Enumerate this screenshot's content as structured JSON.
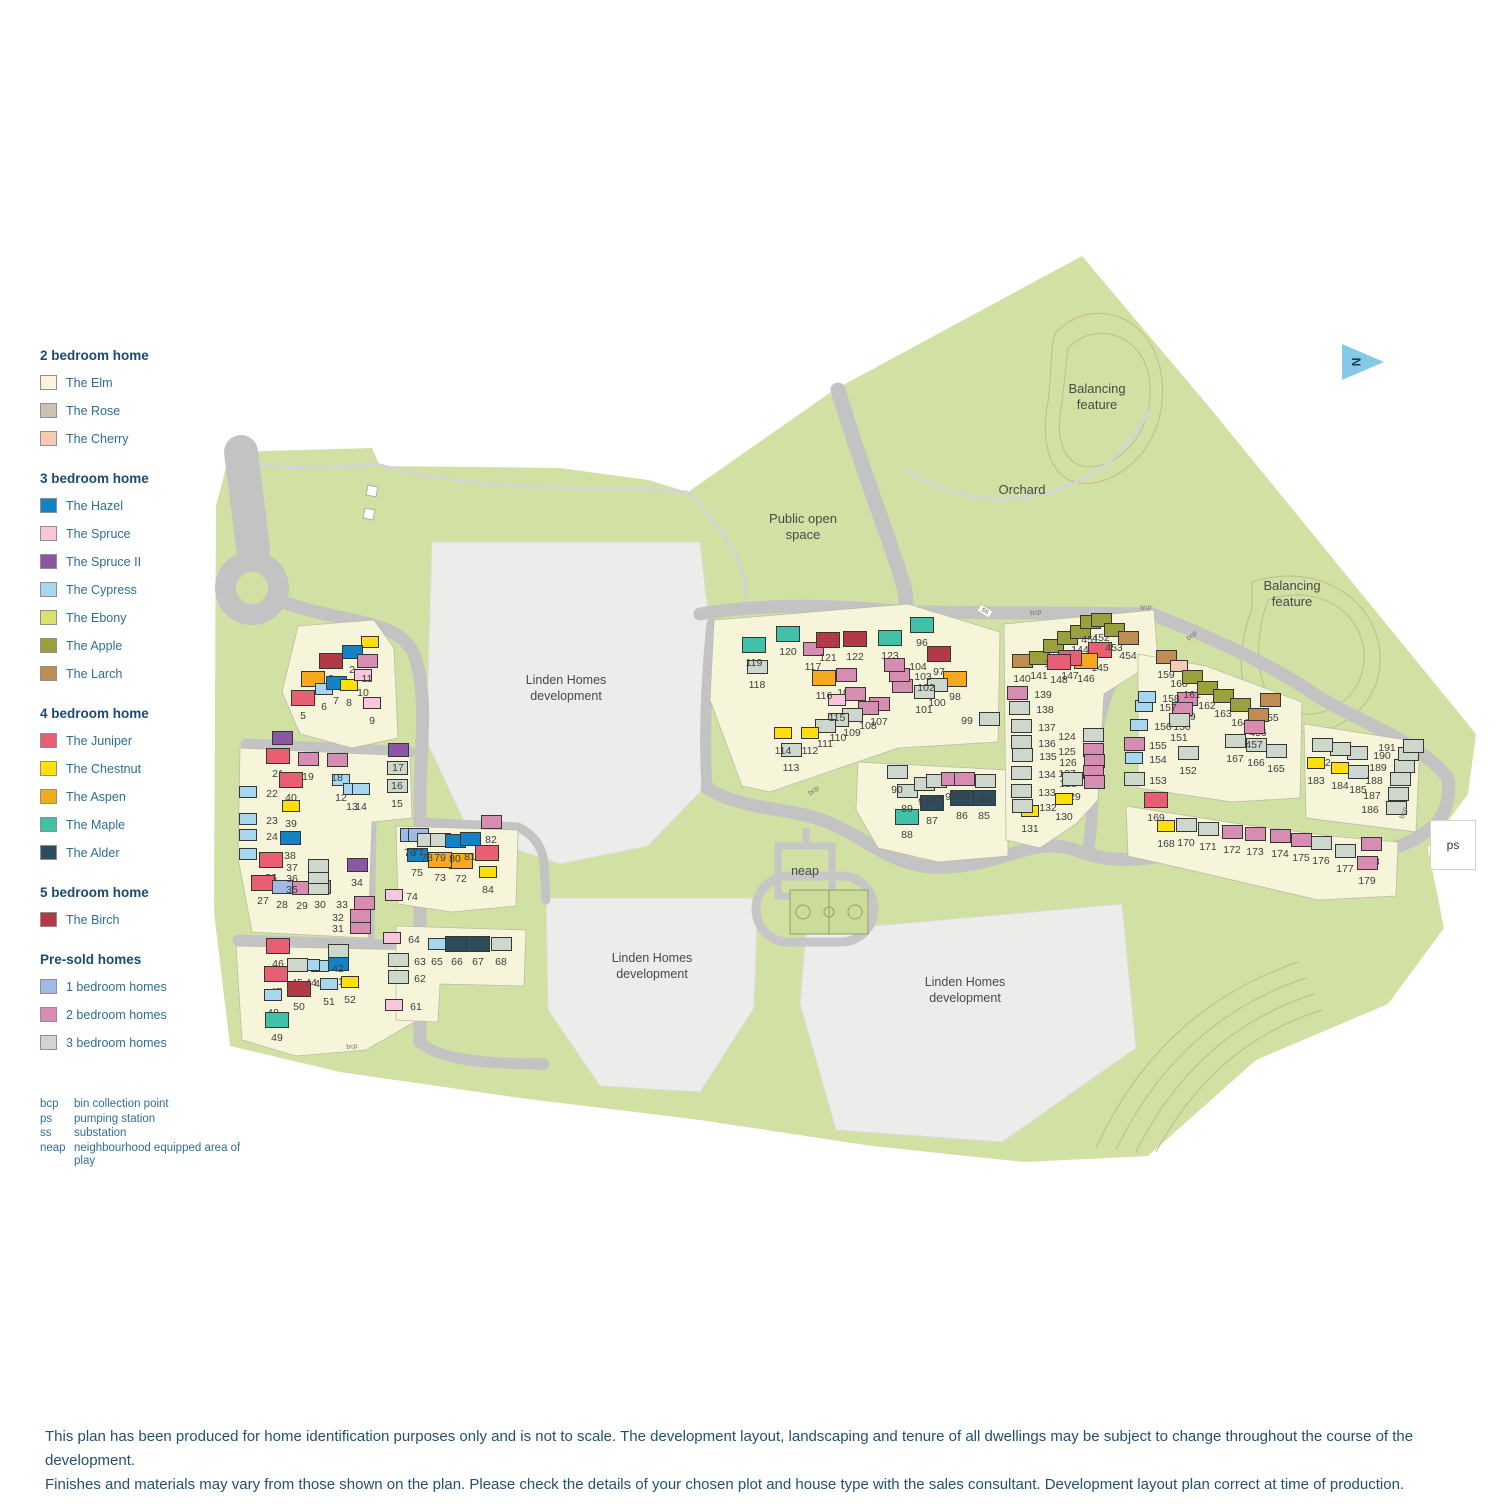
{
  "colors": {
    "elm": "#fbf3da",
    "rose": "#cdc2b2",
    "cherry": "#f6cbb2",
    "hazel": "#1383c4",
    "spruce": "#f7c6da",
    "spruce2": "#8b57a5",
    "cypress": "#a7d6ef",
    "ebony": "#dce06e",
    "apple": "#9aa03b",
    "larch": "#bf8c51",
    "juniper": "#e85e72",
    "chestnut": "#ffdf0a",
    "aspen": "#f5a91f",
    "maple": "#40c1a8",
    "alder": "#2e4d5c",
    "birch": "#b03b47",
    "ps1": "#9fbae5",
    "ps2": "#d78db1",
    "ps3": "#cdd7cc"
  },
  "legend": {
    "sections": [
      {
        "title": "2 bedroom home",
        "items": [
          {
            "label": "The Elm",
            "color": "#fbf3da"
          },
          {
            "label": "The Rose",
            "color": "#cdc2b2"
          },
          {
            "label": "The Cherry",
            "color": "#f6cbb2"
          }
        ]
      },
      {
        "title": "3 bedroom home",
        "items": [
          {
            "label": "The Hazel",
            "color": "#1383c4"
          },
          {
            "label": "The Spruce",
            "color": "#f7c6da"
          },
          {
            "label": "The Spruce II",
            "color": "#8b57a5"
          },
          {
            "label": "The Cypress",
            "color": "#a7d6ef"
          },
          {
            "label": "The Ebony",
            "color": "#dce06e"
          },
          {
            "label": "The Apple",
            "color": "#9aa03b"
          },
          {
            "label": "The Larch",
            "color": "#bf8c51"
          }
        ]
      },
      {
        "title": "4 bedroom home",
        "items": [
          {
            "label": "The Juniper",
            "color": "#e85e72"
          },
          {
            "label": "The Chestnut",
            "color": "#ffdf0a"
          },
          {
            "label": "The Aspen",
            "color": "#f5a91f"
          },
          {
            "label": "The Maple",
            "color": "#40c1a8"
          },
          {
            "label": "The Alder",
            "color": "#2e4d5c"
          }
        ]
      },
      {
        "title": "5 bedroom home",
        "items": [
          {
            "label": "The Birch",
            "color": "#b03b47"
          }
        ]
      },
      {
        "title": "Pre-sold homes",
        "items": [
          {
            "label": "1 bedroom homes",
            "color": "#9fbae5"
          },
          {
            "label": "2 bedroom homes",
            "color": "#d78db1"
          },
          {
            "label": "3 bedroom homes",
            "color": "#cdd7cc"
          }
        ]
      }
    ],
    "abbreviations": [
      {
        "abbr": "bcp",
        "desc": "bin collection point"
      },
      {
        "abbr": "ps",
        "desc": "pumping station"
      },
      {
        "abbr": "ss",
        "desc": "substation"
      },
      {
        "abbr": "neap",
        "desc": "neighbourhood equipped area of play"
      }
    ]
  },
  "markers": {
    "ps": "ps",
    "ss": "ss",
    "north": "N"
  },
  "bcp_text": "bcp",
  "bcp_markers": [
    {
      "x": 352,
      "y": 1047,
      "rot": -5
    },
    {
      "x": 814,
      "y": 791,
      "rot": -38
    },
    {
      "x": 1036,
      "y": 613,
      "rot": -8
    },
    {
      "x": 1146,
      "y": 608,
      "rot": -5
    },
    {
      "x": 1192,
      "y": 636,
      "rot": -42
    },
    {
      "x": 1404,
      "y": 813,
      "rot": -72
    }
  ],
  "map_labels": [
    {
      "name": "balancing-feature-1-label",
      "text": "Balancing\nfeature",
      "x": 1097,
      "y": 397,
      "cls": "area"
    },
    {
      "name": "orchard-label",
      "text": "Orchard",
      "x": 1022,
      "y": 490,
      "cls": "area"
    },
    {
      "name": "balancing-feature-2-label",
      "text": "Balancing\nfeature",
      "x": 1292,
      "y": 594,
      "cls": "area"
    },
    {
      "name": "public-open-space-label",
      "text": "Public open\nspace",
      "x": 803,
      "y": 527,
      "cls": "area"
    },
    {
      "name": "development-area-1-label",
      "text": "Linden Homes\ndevelopment",
      "x": 566,
      "y": 688,
      "cls": "dev"
    },
    {
      "name": "development-area-2-label",
      "text": "Linden Homes\ndevelopment",
      "x": 652,
      "y": 966,
      "cls": "dev"
    },
    {
      "name": "development-area-3-label",
      "text": "Linden Homes\ndevelopment",
      "x": 965,
      "y": 990,
      "cls": "dev"
    },
    {
      "name": "neap-label",
      "text": "neap",
      "x": 805,
      "y": 871,
      "cls": "dev"
    }
  ],
  "plots": [
    [
      1,
      370,
      660,
      "chestnut"
    ],
    [
      2,
      352,
      670,
      "hazel"
    ],
    [
      3,
      331,
      679,
      "birch"
    ],
    [
      4,
      313,
      697,
      "aspen"
    ],
    [
      5,
      303,
      716,
      "juniper"
    ],
    [
      6,
      324,
      707,
      "cypress"
    ],
    [
      7,
      336,
      701,
      "hazel"
    ],
    [
      8,
      349,
      703,
      "chestnut"
    ],
    [
      9,
      372,
      721,
      "spruce"
    ],
    [
      10,
      363,
      693,
      "spruce"
    ],
    [
      11,
      367,
      679,
      "ps2"
    ],
    [
      12,
      341,
      798,
      "cypress"
    ],
    [
      13,
      352,
      807,
      "cypress"
    ],
    [
      14,
      361,
      807,
      "cypress"
    ],
    [
      15,
      397,
      804,
      "ps3"
    ],
    [
      16,
      397,
      786,
      "ps3"
    ],
    [
      17,
      398,
      768,
      "spruce2"
    ],
    [
      18,
      337,
      778,
      "ps2"
    ],
    [
      19,
      308,
      777,
      "ps2"
    ],
    [
      20,
      282,
      756,
      "spruce2"
    ],
    [
      21,
      278,
      774,
      "juniper"
    ],
    [
      22,
      272,
      794,
      "cypress",
      -24,
      -2
    ],
    [
      23,
      272,
      821,
      "cypress",
      -24,
      -2
    ],
    [
      24,
      272,
      837,
      "cypress",
      -24,
      -2
    ],
    [
      25,
      272,
      856,
      "cypress",
      -24,
      -2
    ],
    [
      26,
      271,
      878,
      "juniper"
    ],
    [
      27,
      263,
      901,
      "juniper"
    ],
    [
      28,
      282,
      905,
      "ps1"
    ],
    [
      29,
      302,
      906,
      "ps2"
    ],
    [
      30,
      320,
      905,
      "ps2"
    ],
    [
      31,
      338,
      929,
      "ps2",
      22,
      -2
    ],
    [
      32,
      338,
      918,
      "ps2",
      22,
      -2
    ],
    [
      33,
      342,
      905,
      "ps2",
      22,
      -2
    ],
    [
      34,
      357,
      883,
      "spruce2"
    ],
    [
      35,
      292,
      890,
      "ps3",
      26,
      -2
    ],
    [
      36,
      292,
      879,
      "ps3",
      26,
      -2
    ],
    [
      37,
      292,
      868,
      "ps3",
      26,
      -2
    ],
    [
      38,
      290,
      856,
      "hazel"
    ],
    [
      39,
      291,
      824,
      "chestnut"
    ],
    [
      40,
      291,
      798,
      "juniper"
    ],
    [
      41,
      338,
      982,
      "hazel"
    ],
    [
      42,
      338,
      969,
      "ps3"
    ],
    [
      43,
      320,
      984,
      "cypress"
    ],
    [
      44,
      311,
      983,
      "cypress"
    ],
    [
      45,
      297,
      983,
      "ps3"
    ],
    [
      46,
      278,
      964,
      "juniper"
    ],
    [
      47,
      276,
      992,
      "juniper"
    ],
    [
      48,
      273,
      1013,
      "cypress"
    ],
    [
      49,
      277,
      1038,
      "maple"
    ],
    [
      50,
      299,
      1007,
      "birch"
    ],
    [
      51,
      329,
      1002,
      "cypress"
    ],
    [
      52,
      350,
      1000,
      "chestnut"
    ],
    [
      61,
      416,
      1007,
      "spruce",
      -22,
      -2
    ],
    [
      62,
      420,
      979,
      "ps3",
      -22,
      -2
    ],
    [
      63,
      420,
      962,
      "ps3",
      -22,
      -2
    ],
    [
      64,
      414,
      940,
      "spruce",
      -22,
      -2
    ],
    [
      65,
      437,
      962,
      "cypress"
    ],
    [
      66,
      457,
      962,
      "alder"
    ],
    [
      67,
      478,
      962,
      "alder"
    ],
    [
      68,
      501,
      962,
      "ps3"
    ],
    [
      72,
      461,
      879,
      "aspen"
    ],
    [
      73,
      440,
      878,
      "aspen"
    ],
    [
      74,
      412,
      897,
      "spruce",
      -18,
      -2
    ],
    [
      75,
      417,
      873,
      "hazel"
    ],
    [
      76,
      410,
      853,
      "ps1"
    ],
    [
      77,
      418,
      853,
      "ps1"
    ],
    [
      78,
      427,
      858,
      "ps3"
    ],
    [
      79,
      440,
      858,
      "ps3"
    ],
    [
      80,
      455,
      859,
      "hazel"
    ],
    [
      81,
      470,
      857,
      "hazel"
    ],
    [
      82,
      491,
      840,
      "ps2"
    ],
    [
      83,
      487,
      871,
      "juniper"
    ],
    [
      84,
      488,
      890,
      "chestnut"
    ],
    [
      85,
      984,
      816,
      "alder"
    ],
    [
      86,
      962,
      816,
      "alder"
    ],
    [
      87,
      932,
      821,
      "alder"
    ],
    [
      88,
      907,
      835,
      "maple"
    ],
    [
      89,
      907,
      809,
      "ps3"
    ],
    [
      90,
      897,
      790,
      "ps3"
    ],
    [
      91,
      924,
      802,
      "ps3"
    ],
    [
      92,
      936,
      799,
      "ps3"
    ],
    [
      93,
      951,
      797,
      "ps2"
    ],
    [
      94,
      964,
      797,
      "ps2"
    ],
    [
      95,
      985,
      799,
      "ps3"
    ],
    [
      96,
      922,
      643,
      "maple"
    ],
    [
      97,
      939,
      672,
      "birch"
    ],
    [
      98,
      955,
      697,
      "aspen"
    ],
    [
      99,
      967,
      721,
      "ps3",
      22,
      -2
    ],
    [
      100,
      937,
      703,
      "ps3"
    ],
    [
      101,
      924,
      710,
      "ps3"
    ],
    [
      102,
      926,
      688,
      "ps2",
      -24,
      -2
    ],
    [
      103,
      923,
      677,
      "ps2",
      -24,
      -2
    ],
    [
      104,
      918,
      667,
      "ps2",
      -24,
      -2
    ],
    [
      105,
      846,
      693,
      "ps2"
    ],
    [
      106,
      855,
      712,
      "ps2"
    ],
    [
      107,
      879,
      722,
      "ps2"
    ],
    [
      108,
      868,
      726,
      "ps2"
    ],
    [
      109,
      852,
      733,
      "ps3"
    ],
    [
      110,
      838,
      738,
      "ps3"
    ],
    [
      111,
      825,
      744,
      "ps3"
    ],
    [
      112,
      810,
      751,
      "chestnut"
    ],
    [
      113,
      791,
      768,
      "ps3"
    ],
    [
      114,
      783,
      751,
      "chestnut"
    ],
    [
      115,
      837,
      718,
      "spruce"
    ],
    [
      116,
      824,
      696,
      "aspen"
    ],
    [
      117,
      813,
      667,
      "ps2"
    ],
    [
      118,
      757,
      685,
      "ps3"
    ],
    [
      119,
      754,
      663,
      "maple"
    ],
    [
      120,
      788,
      652,
      "maple"
    ],
    [
      121,
      828,
      658,
      "birch"
    ],
    [
      122,
      855,
      657,
      "birch"
    ],
    [
      123,
      890,
      656,
      "maple"
    ],
    [
      124,
      1067,
      737,
      "ps3",
      26,
      -2
    ],
    [
      125,
      1067,
      752,
      "ps2",
      26,
      -2
    ],
    [
      126,
      1068,
      763,
      "ps2",
      26,
      -2
    ],
    [
      127,
      1067,
      774,
      "ps2",
      26,
      -2
    ],
    [
      128,
      1068,
      784,
      "ps2",
      26,
      -2
    ],
    [
      129,
      1072,
      797,
      "ps3"
    ],
    [
      130,
      1064,
      817,
      "chestnut"
    ],
    [
      131,
      1030,
      829,
      "chestnut"
    ],
    [
      132,
      1048,
      808,
      "ps3",
      -26,
      -2
    ],
    [
      133,
      1047,
      793,
      "ps3",
      -26,
      -2
    ],
    [
      134,
      1047,
      775,
      "ps3",
      -26,
      -2
    ],
    [
      135,
      1048,
      757,
      "ps3",
      -26,
      -2
    ],
    [
      136,
      1047,
      744,
      "ps3",
      -26,
      -2
    ],
    [
      137,
      1047,
      728,
      "ps3",
      -26,
      -2
    ],
    [
      138,
      1045,
      710,
      "ps3",
      -26,
      -2
    ],
    [
      139,
      1043,
      695,
      "ps2",
      -26,
      -2
    ],
    [
      140,
      1022,
      679,
      "larch"
    ],
    [
      141,
      1039,
      676,
      "apple"
    ],
    [
      142,
      1053,
      664,
      "apple"
    ],
    [
      143,
      1067,
      656,
      "apple"
    ],
    [
      144,
      1080,
      650,
      "apple"
    ],
    [
      145,
      1100,
      668,
      "juniper"
    ],
    [
      146,
      1086,
      679,
      "aspen"
    ],
    [
      147,
      1070,
      676,
      "juniper"
    ],
    [
      148,
      1059,
      680,
      "juniper"
    ],
    [
      451,
      1090,
      640,
      "apple"
    ],
    [
      452,
      1101,
      638,
      "apple"
    ],
    [
      453,
      1114,
      648,
      "apple"
    ],
    [
      454,
      1128,
      656,
      "larch"
    ],
    [
      149,
      1187,
      717,
      "ps2"
    ],
    [
      150,
      1182,
      727,
      "ps2"
    ],
    [
      151,
      1179,
      738,
      "ps3"
    ],
    [
      152,
      1188,
      771,
      "ps3"
    ],
    [
      153,
      1158,
      781,
      "ps3",
      -24,
      -2
    ],
    [
      154,
      1158,
      760,
      "cypress",
      -24,
      -2
    ],
    [
      155,
      1158,
      746,
      "ps2",
      -24,
      -2
    ],
    [
      156,
      1163,
      727,
      "cypress",
      -24,
      -2
    ],
    [
      157,
      1168,
      708,
      "cypress",
      -24,
      -2
    ],
    [
      158,
      1171,
      699,
      "cypress",
      -24,
      -2
    ],
    [
      159,
      1166,
      675,
      "larch"
    ],
    [
      160,
      1179,
      684,
      "cherry"
    ],
    [
      161,
      1192,
      695,
      "apple"
    ],
    [
      162,
      1207,
      706,
      "apple"
    ],
    [
      163,
      1223,
      714,
      "apple"
    ],
    [
      164,
      1240,
      723,
      "apple"
    ],
    [
      165,
      1276,
      769,
      "ps3"
    ],
    [
      166,
      1256,
      763,
      "ps3"
    ],
    [
      167,
      1235,
      759,
      "ps3"
    ],
    [
      455,
      1270,
      718,
      "larch"
    ],
    [
      456,
      1258,
      733,
      "larch"
    ],
    [
      457,
      1254,
      745,
      "ps2"
    ],
    [
      168,
      1166,
      844,
      "chestnut"
    ],
    [
      169,
      1156,
      818,
      "juniper"
    ],
    [
      170,
      1186,
      843,
      "ps3"
    ],
    [
      171,
      1208,
      847,
      "ps3"
    ],
    [
      172,
      1232,
      850,
      "ps2"
    ],
    [
      173,
      1255,
      852,
      "ps2"
    ],
    [
      174,
      1280,
      854,
      "ps2"
    ],
    [
      175,
      1301,
      858,
      "ps2"
    ],
    [
      176,
      1321,
      861,
      "ps3"
    ],
    [
      177,
      1345,
      869,
      "ps3"
    ],
    [
      178,
      1371,
      862,
      "ps2"
    ],
    [
      179,
      1367,
      881,
      "ps2"
    ],
    [
      180,
      1357,
      771,
      "ps3"
    ],
    [
      181,
      1340,
      767,
      "ps3"
    ],
    [
      182,
      1322,
      763,
      "ps3"
    ],
    [
      183,
      1316,
      781,
      "chestnut"
    ],
    [
      184,
      1340,
      786,
      "chestnut"
    ],
    [
      185,
      1358,
      790,
      "ps3"
    ],
    [
      186,
      1370,
      810,
      "ps3",
      26,
      -2
    ],
    [
      187,
      1372,
      796,
      "ps3",
      26,
      -2
    ],
    [
      188,
      1374,
      781,
      "ps3",
      26,
      -2
    ],
    [
      189,
      1378,
      768,
      "ps3",
      26,
      -2
    ],
    [
      190,
      1382,
      756,
      "ps3",
      26,
      -2
    ],
    [
      191,
      1387,
      748,
      "ps3",
      26,
      -2
    ]
  ],
  "footer": {
    "line1": "This plan has been produced for home identification purposes only and is not to scale. The development layout, landscaping and tenure of all dwellings may be subject to change throughout the course of the development.",
    "line2": "Finishes and materials may vary from those shown on the plan. Please check the details of your chosen plot and house type with the sales consultant. Development layout plan correct at time of production."
  }
}
